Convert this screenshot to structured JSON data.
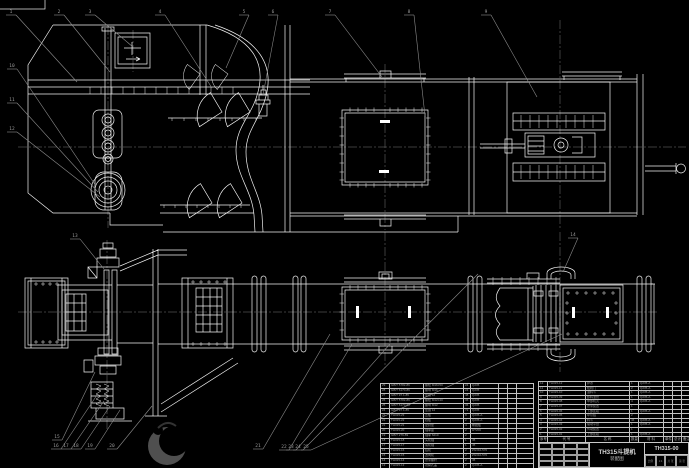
{
  "drawing": {
    "title": "TH315斗提机",
    "subtitle": "装配图",
    "drawing_no": "TH315-00",
    "scale_cells": [
      "比例",
      "1:4",
      "共 张",
      "第 张"
    ],
    "colors": {
      "background": "#000000",
      "line": "#f2f2f2",
      "annotation": "#8c8c8c",
      "centerline": "#787878",
      "table_line": "#c2c2c2",
      "table_text": "#9a9a9a"
    }
  },
  "right_table": {
    "header": [
      "序号",
      "代 号",
      "名  称",
      "数量",
      "材 料",
      "单件",
      "总计",
      "备注"
    ],
    "col_widths": [
      9,
      38,
      44,
      9,
      25,
      9,
      9,
      8
    ],
    "rows": [
      [
        "12",
        "TH315-12",
        "护罩",
        "1",
        "Q235-A",
        "",
        "",
        ""
      ],
      [
        "11",
        "TH315-11",
        "检视门",
        "2",
        "Q235-A",
        "",
        "",
        ""
      ],
      [
        "10",
        "TH315-10",
        "进料斗",
        "1",
        "Q235-A",
        "",
        "",
        ""
      ],
      [
        "9",
        "TH315-09",
        "卸料溜管",
        "1",
        "Q235-A",
        "",
        "",
        ""
      ],
      [
        "8",
        "TH315-08",
        "中部机壳",
        "4",
        "Q235-A",
        "",
        "",
        ""
      ],
      [
        "7",
        "TH315-07",
        "张紧装置",
        "1",
        "",
        "",
        "",
        ""
      ],
      [
        "6",
        "TH315-06",
        "下部区段",
        "1",
        "Q235-A",
        "",
        "",
        ""
      ],
      [
        "5",
        "TH315-05",
        "牵引链",
        "2",
        "",
        "",
        "",
        ""
      ],
      [
        "4",
        "TH315-04",
        "料斗",
        "46",
        "Q235-A",
        "",
        "",
        ""
      ],
      [
        "3",
        "TH315-03",
        "驱动平台",
        "1",
        "Q235-A",
        "",
        "",
        ""
      ],
      [
        "2",
        "TH315-02",
        "传动装置",
        "1",
        "",
        "",
        "",
        ""
      ],
      [
        "1",
        "TH315-01",
        "上部区段",
        "1",
        "Q235-A",
        "",
        "",
        ""
      ]
    ]
  },
  "left_table": {
    "col_widths": [
      9,
      34,
      40,
      7,
      28,
      9,
      9,
      17
    ],
    "rows": [
      [
        "29",
        "GB/T 5782-86",
        "螺栓 M16×50",
        "24",
        "Q235",
        "",
        "",
        ""
      ],
      [
        "28",
        "GB/T 6170-86",
        "螺母 M16",
        "24",
        "Q235",
        "",
        "",
        ""
      ],
      [
        "27",
        "GB/T 97.1-85",
        "垫圈 16",
        "48",
        "Q235",
        "",
        "",
        ""
      ],
      [
        "26",
        "GB/T 5782-86",
        "螺栓 M12×40",
        "36",
        "Q235",
        "",
        "",
        ""
      ],
      [
        "25",
        "GB/T 6170-86",
        "螺母 M12",
        "36",
        "Q235",
        "",
        "",
        ""
      ],
      [
        "24",
        "GB/T 97.1-85",
        "垫圈 12",
        "72",
        "Q235",
        "",
        "",
        ""
      ],
      [
        "23",
        "TH315-23",
        "压板",
        "8",
        "Q235-A",
        "",
        "",
        ""
      ],
      [
        "22",
        "TH315-22",
        "挡板",
        "2",
        "Q235-A",
        "",
        "",
        ""
      ],
      [
        "21",
        "TH315-21",
        "密封垫",
        "4",
        "橡胶板",
        "",
        "",
        ""
      ],
      [
        "20",
        "TH315-20",
        "轴承座",
        "2",
        "HT200",
        "",
        "",
        ""
      ],
      [
        "19",
        "GB/T 276-89",
        "轴承 6210",
        "2",
        "",
        "",
        "",
        ""
      ],
      [
        "18",
        "TH315-18",
        "头轮轴",
        "1",
        "45",
        "",
        "",
        ""
      ],
      [
        "17",
        "TH315-17",
        "尾轮轴",
        "1",
        "45",
        "",
        "",
        ""
      ],
      [
        "16",
        "TH315-16",
        "链轮",
        "2",
        "ZG310-570",
        "",
        "",
        ""
      ],
      [
        "15",
        "TH315-15",
        "改向轮",
        "2",
        "ZG310-570",
        "",
        "",
        ""
      ],
      [
        "14",
        "TH315-14",
        "张紧螺杆",
        "2",
        "45",
        "",
        "",
        ""
      ],
      [
        "13",
        "TH315-13",
        "观察孔盖",
        "2",
        "Q235-A",
        "",
        "",
        ""
      ]
    ]
  },
  "balloons": [
    {
      "n": "1",
      "x": 11,
      "y": 13,
      "tx": 77,
      "ty": 82
    },
    {
      "n": "2",
      "x": 59,
      "y": 13,
      "tx": 110,
      "ty": 72
    },
    {
      "n": "3",
      "x": 90,
      "y": 13,
      "tx": 133,
      "ty": 47
    },
    {
      "n": "4",
      "x": 160,
      "y": 13,
      "tx": 212,
      "ty": 88
    },
    {
      "n": "5",
      "x": 244,
      "y": 13,
      "tx": 226,
      "ty": 68
    },
    {
      "n": "6",
      "x": 273,
      "y": 13,
      "tx": 263,
      "ty": 95
    },
    {
      "n": "7",
      "x": 330,
      "y": 13,
      "tx": 382,
      "ty": 77
    },
    {
      "n": "8",
      "x": 409,
      "y": 13,
      "tx": 425,
      "ty": 116
    },
    {
      "n": "9",
      "x": 486,
      "y": 13,
      "tx": 537,
      "ty": 97
    },
    {
      "n": "10",
      "x": 12,
      "y": 67,
      "tx": 96,
      "ty": 186
    },
    {
      "n": "11",
      "x": 12,
      "y": 101,
      "tx": 98,
      "ty": 192
    },
    {
      "n": "12",
      "x": 12,
      "y": 130,
      "tx": 100,
      "ty": 197
    },
    {
      "n": "13",
      "x": 75,
      "y": 237,
      "tx": 104,
      "ty": 269
    },
    {
      "n": "14",
      "x": 573,
      "y": 236,
      "tx": 563,
      "ty": 272
    },
    {
      "n": "15",
      "x": 57,
      "y": 438,
      "tx": 95,
      "ty": 372
    },
    {
      "n": "16",
      "x": 56,
      "y": 447,
      "tx": 97,
      "ty": 395
    },
    {
      "n": "17",
      "x": 66,
      "y": 447,
      "tx": 104,
      "ty": 401
    },
    {
      "n": "18",
      "x": 76,
      "y": 447,
      "tx": 110,
      "ty": 406
    },
    {
      "n": "19",
      "x": 90,
      "y": 447,
      "tx": 120,
      "ty": 410
    },
    {
      "n": "20",
      "x": 112,
      "y": 447,
      "tx": 152,
      "ty": 406
    },
    {
      "n": "21",
      "x": 258,
      "y": 447,
      "tx": 330,
      "ty": 334
    },
    {
      "n": "22",
      "x": 284,
      "y": 448,
      "tx": 352,
      "ty": 344
    },
    {
      "n": "23",
      "x": 291,
      "y": 448,
      "tx": 390,
      "ty": 344
    },
    {
      "n": "24",
      "x": 298,
      "y": 448,
      "tx": 478,
      "ty": 274
    },
    {
      "n": "25",
      "x": 306,
      "y": 448,
      "tx": 562,
      "ty": 334
    }
  ]
}
